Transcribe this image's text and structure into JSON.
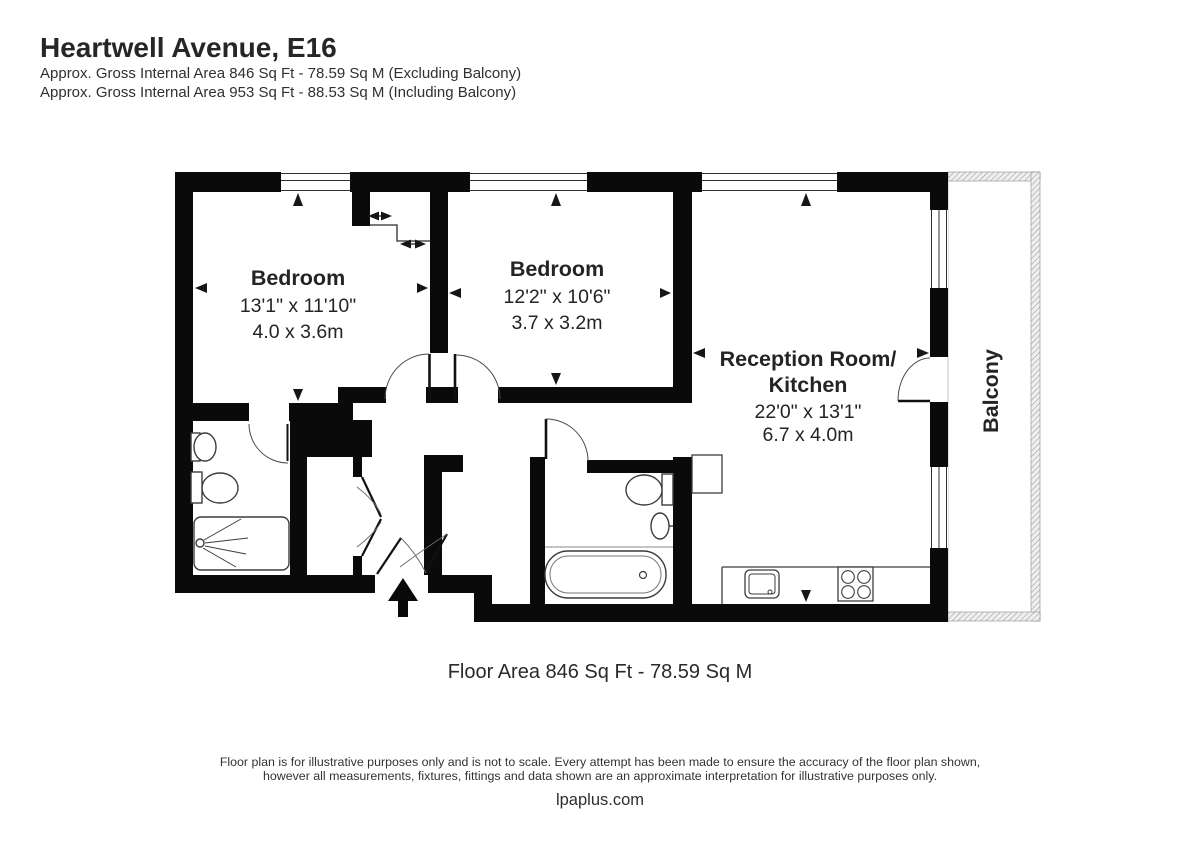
{
  "header": {
    "title": "Heartwell Avenue, E16",
    "subtitle_line1": "Approx. Gross Internal Area 846 Sq Ft - 78.59 Sq M (Excluding Balcony)",
    "subtitle_line2": "Approx. Gross Internal Area 953 Sq Ft - 88.53 Sq M (Including Balcony)"
  },
  "floorplan": {
    "bedroom1": {
      "name": "Bedroom",
      "imperial": "13'1\" x 11'10\"",
      "metric": "4.0 x 3.6m"
    },
    "bedroom2": {
      "name": "Bedroom",
      "imperial": "12'2\" x 10'6\"",
      "metric": "3.7 x 3.2m"
    },
    "reception": {
      "name_line1": "Reception Room/",
      "name_line2": "Kitchen",
      "imperial": "22'0\" x 13'1\"",
      "metric": "6.7 x 4.0m"
    },
    "balcony": {
      "name": "Balcony"
    }
  },
  "summary": {
    "floor_area_label": "Floor Area 846 Sq Ft - 78.59 Sq M"
  },
  "footer": {
    "disclaimer_line1": "Floor plan is for illustrative purposes only and is not to scale. Every attempt has been made to ensure the accuracy of the floor plan shown,",
    "disclaimer_line2": "however all measurements, fixtures, fittings and data shown are an approximate interpretation for illustrative purposes only.",
    "website": "lpaplus.com"
  },
  "colors": {
    "wall": "#0a0a0a",
    "text": "#2a2a2a",
    "fixture_stroke": "#3c3c3c",
    "hatch": "#9a9a9a",
    "door_swing": "#555555"
  }
}
